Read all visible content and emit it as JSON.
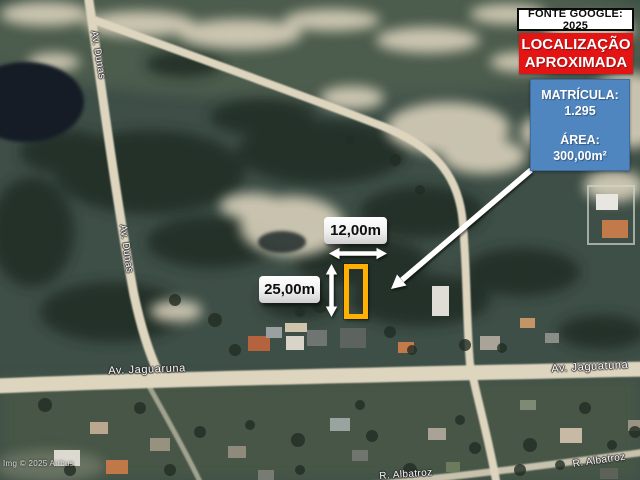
{
  "annotations": {
    "source_box": "FONTE GOOGLE: 2025",
    "location_box": {
      "line1": "LOCALIZAÇÃO",
      "line2": "APROXIMADA"
    },
    "info_box": {
      "registry_label": "MATRÍCULA:",
      "registry_value": "1.295",
      "area_label": "ÁREA:",
      "area_value": "300,00m²"
    },
    "dimensions": {
      "width_label": "12,00m",
      "height_label": "25,00m"
    }
  },
  "map": {
    "street_labels": [
      {
        "text": "Av. Dunas"
      },
      {
        "text": "Av. Dunas"
      },
      {
        "text": "Av. Jaguaruna"
      },
      {
        "text": "Av. Jaguatuna"
      },
      {
        "text": "R. Albatroz"
      },
      {
        "text": "R. Albatroz"
      }
    ],
    "attribution": "Img © 2025 Airbus"
  },
  "colors": {
    "highlight_red": "#e31414",
    "info_blue": "#4f86c0",
    "lot_orange": "#ffb000",
    "arrow_white": "#ffffff",
    "road_tan": "#ded5bf"
  }
}
